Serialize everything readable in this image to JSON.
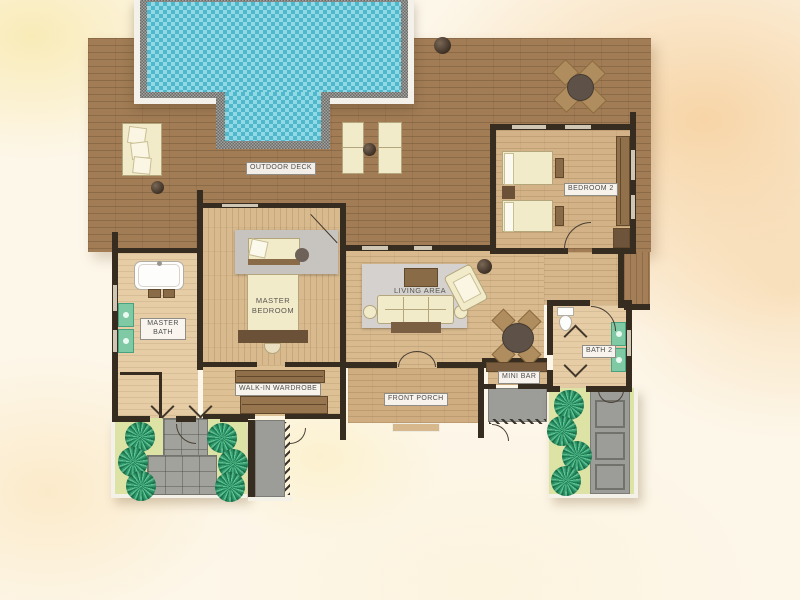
{
  "type": "resort-villa-floor-plan",
  "labels": {
    "outdoor_deck": "OUTDOOR DECK",
    "bedroom_2": "BEDROOM 2",
    "master_bedroom": "MASTER BEDROOM",
    "living_area": "LIVING AREA",
    "master_bath": "MASTER BATH",
    "walk_in_wardrobe": "WALK-IN WARDROBE",
    "front_porch": "FRONT PORCH",
    "mini_bar": "MINI BAR",
    "bath_2": "BATH 2"
  },
  "colors": {
    "pool_water": "#63c7da",
    "pool_stone_border": "#8e8e8a",
    "deck_wood": "#a17c55",
    "interior_wood": "#d8ba8e",
    "wall": "#362c20",
    "grass": "#dce3a4",
    "shrub": "#2f9a6e",
    "vanity": "#7fcaa4",
    "stone_path": "#a2a29c",
    "background_wash": "#fdf7ea"
  }
}
